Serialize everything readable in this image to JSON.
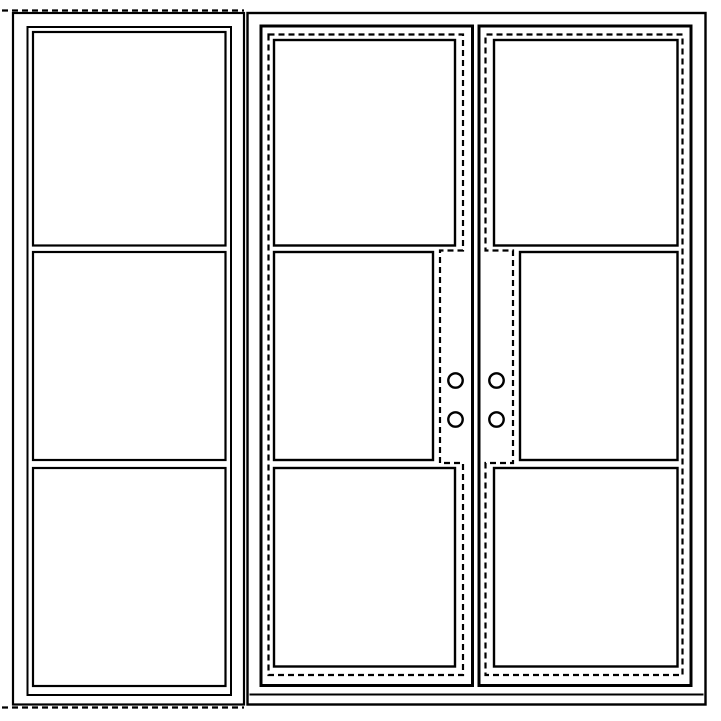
{
  "meta": {
    "title": "Elevation line drawing: double 3-lite door unit with 3-lite sidelite panel"
  },
  "colors": {
    "background": "#ffffff",
    "line": "#000000"
  },
  "canvas": {
    "width": 721,
    "height": 721
  },
  "sidelite": {
    "glass_lites": 3,
    "dashed_markings": [
      "head",
      "sill"
    ]
  },
  "door_unit": {
    "leaves": 2,
    "lites_per_leaf": 3,
    "handle_holes_per_leaf": 2,
    "handle_holes_total": 4,
    "leaf_sash_outline_style": "dashed",
    "lock_stile_outline_style": "dashed"
  }
}
